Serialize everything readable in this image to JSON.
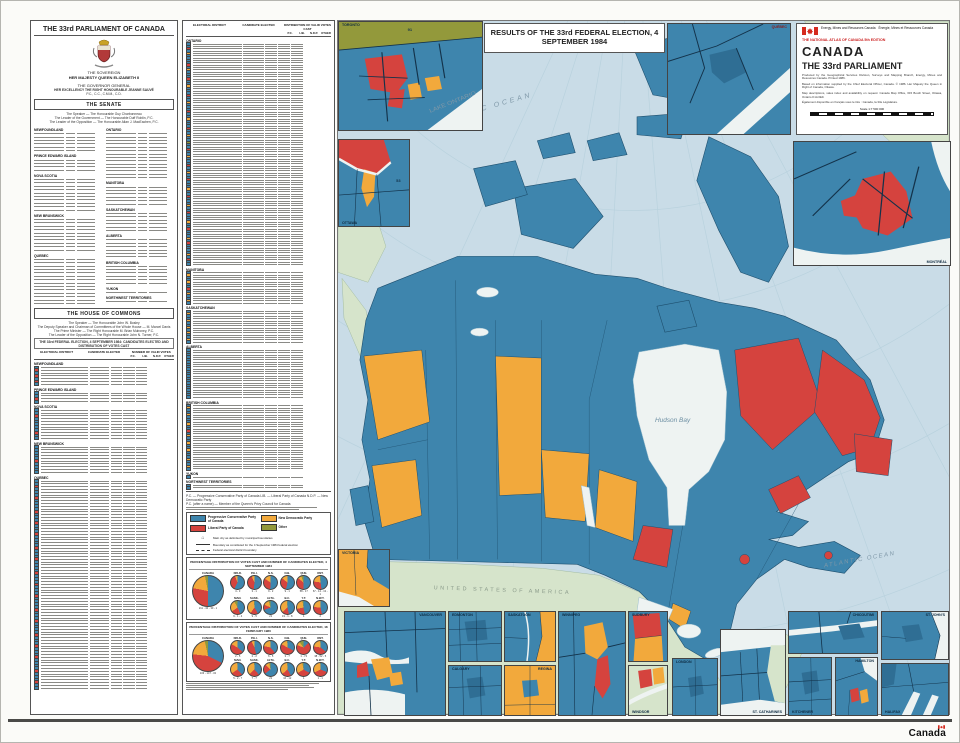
{
  "colors": {
    "pc": "#3e85ad",
    "lib": "#d5433e",
    "ndp": "#f2a93c",
    "other": "#93993b",
    "sea": "#c9dce7",
    "foreign_land": "#d6e4cb",
    "water": "#eef3f2",
    "boundary": "#1e4f6e"
  },
  "left_panel": {
    "title": "THE 33rd PARLIAMENT OF CANADA",
    "sovereign_heading": "THE SOVEREIGN",
    "sovereign_name": "HER MAJESTY QUEEN ELIZABETH II",
    "governor_heading": "THE GOVERNOR GENERAL",
    "governor_name": "HER EXCELLENCY THE RIGHT HONOURABLE JEANNE SAUVÉ",
    "governor_postnominals": "P.C., C.C., C.M.M., C.D.",
    "senate": {
      "title": "THE SENATE",
      "intro_lines": [
        "The Speaker — The Honourable Guy Charbonneau",
        "The Leader of the Government — The Honourable Duff Roblin, P.C.",
        "The Leader of the Opposition — The Honourable Allan J. MacEachen, P.C."
      ],
      "columns": [
        {
          "groups": [
            {
              "name": "NEWFOUNDLAND",
              "count": 6
            },
            {
              "name": "PRINCE EDWARD ISLAND",
              "count": 4
            },
            {
              "name": "NOVA SCOTIA",
              "count": 10
            },
            {
              "name": "NEW BRUNSWICK",
              "count": 10
            },
            {
              "name": "QUEBEC",
              "count": 14
            }
          ]
        },
        {
          "groups": [
            {
              "name": "ONTARIO",
              "count": 14
            },
            {
              "name": "MANITOBA",
              "count": 6
            },
            {
              "name": "SASKATCHEWAN",
              "count": 6
            },
            {
              "name": "ALBERTA",
              "count": 6
            },
            {
              "name": "BRITISH COLUMBIA",
              "count": 6
            },
            {
              "name": "YUKON",
              "count": 1
            },
            {
              "name": "NORTHWEST TERRITORIES",
              "count": 1
            }
          ]
        }
      ]
    },
    "commons": {
      "title": "THE HOUSE OF COMMONS",
      "intro_lines": [
        "The Speaker — The Honourable John W. Bosley",
        "The Deputy Speaker and Chairman of Committees of the Whole House — M. Marcel Danis",
        "The Prime Minister — The Right Honourable M. Brian Mulroney, P.C.",
        "The Leader of the Opposition — The Right Honourable John N. Turner, P.C."
      ],
      "table_title": "THE 33rd FEDERAL ELECTION, 4 SEPTEMBER 1984: CANDIDATES ELECTED AND DISTRIBUTION OF VOTES CAST",
      "headers": {
        "district": "ELECTORAL DISTRICT",
        "candidate": "CANDIDATE ELECTED",
        "votes": "NUMBER OF VALID VOTES",
        "dist": "DISTRIBUTION OF VALID VOTES CAST"
      },
      "sub_headers": [
        "P.C.",
        "LIB.",
        "N.D.P.",
        "OTHER"
      ],
      "sections_a": [
        {
          "name": "NEWFOUNDLAND",
          "seats": {
            "pc": 4,
            "lib": 3
          }
        },
        {
          "name": "PRINCE EDWARD ISLAND",
          "seats": {
            "pc": 3,
            "lib": 1
          }
        },
        {
          "name": "NOVA SCOTIA",
          "seats": {
            "pc": 9,
            "lib": 2
          }
        },
        {
          "name": "NEW BRUNSWICK",
          "seats": {
            "pc": 9,
            "lib": 1
          }
        },
        {
          "name": "QUEBEC",
          "seats": {
            "pc": 58,
            "lib": 17
          }
        }
      ],
      "sections_b": [
        {
          "name": "ONTARIO",
          "seats": {
            "pc": 67,
            "lib": 14,
            "ndp": 13,
            "other": 1
          }
        },
        {
          "name": "MANITOBA",
          "seats": {
            "pc": 9,
            "lib": 1,
            "ndp": 4
          }
        },
        {
          "name": "SASKATCHEWAN",
          "seats": {
            "pc": 9,
            "ndp": 5
          }
        },
        {
          "name": "ALBERTA",
          "seats": {
            "pc": 21
          }
        },
        {
          "name": "BRITISH COLUMBIA",
          "seats": {
            "pc": 19,
            "lib": 1,
            "ndp": 8
          }
        },
        {
          "name": "YUKON",
          "seats": {
            "pc": 1
          }
        },
        {
          "name": "NORTHWEST TERRITORIES",
          "seats": {
            "pc": 2
          }
        }
      ]
    },
    "footnote_lines": [
      "P.C. — Progressive Conservative Party of Canada    LIB. — Liberal Party of Canada    N.D.P. — New Democratic Party",
      "P.C. (after a name) — Member of the Queen's Privy Council for Canada"
    ]
  },
  "legend": {
    "entries": [
      {
        "party": "pc",
        "label": "Progressive Conservative Party of Canada"
      },
      {
        "party": "lib",
        "label": "Liberal Party of Canada"
      },
      {
        "party": "ndp",
        "label": "New Democratic Party"
      },
      {
        "party": "other",
        "label": "Other"
      }
    ],
    "notes": [
      {
        "symbol": "city",
        "text": "Main city as delimited by municipal boundaries"
      },
      {
        "symbol": "line",
        "text": "Boundary as constituted for the 4 September 1984 federal election"
      },
      {
        "symbol": "dline",
        "text": "Federal electoral district boundary"
      }
    ]
  },
  "chart_data": [
    {
      "type": "pie",
      "title": "PERCENTAGE DISTRIBUTION OF VOTES CAST AND NUMBER OF CANDIDATES ELECTED, 4 SEPTEMBER 1984",
      "legend_entries": [
        "P.C.",
        "LIB.",
        "N.D.P.",
        "OTHER"
      ],
      "canada": {
        "label": "CANADA",
        "values": [
          50.0,
          28.0,
          18.8,
          3.2
        ],
        "seats": "211 - 40 - 30 - 1"
      },
      "provinces": [
        {
          "label": "NFLD.",
          "values": [
            57.6,
            36.4,
            5.9,
            0.1
          ],
          "seats": "4 - 3"
        },
        {
          "label": "P.E.I.",
          "values": [
            52.0,
            41.0,
            6.5,
            0.5
          ],
          "seats": "3 - 1"
        },
        {
          "label": "N.S.",
          "values": [
            50.7,
            33.6,
            15.2,
            0.5
          ],
          "seats": "9 - 2"
        },
        {
          "label": "N.B.",
          "values": [
            53.6,
            31.9,
            14.1,
            0.4
          ],
          "seats": "9 - 1"
        },
        {
          "label": "QUE.",
          "values": [
            50.2,
            35.4,
            8.8,
            5.6
          ],
          "seats": "58 - 17"
        },
        {
          "label": "ONT.",
          "values": [
            47.6,
            29.8,
            20.8,
            1.8
          ],
          "seats": "67 - 14 - 13 - 1"
        },
        {
          "label": "MAN.",
          "values": [
            43.2,
            21.8,
            27.2,
            7.8
          ],
          "seats": "9 - 1 - 4"
        },
        {
          "label": "SASK.",
          "values": [
            41.7,
            18.2,
            38.4,
            1.7
          ],
          "seats": "9 - 5"
        },
        {
          "label": "ALTA.",
          "values": [
            68.8,
            12.7,
            14.1,
            4.4
          ],
          "seats": "21"
        },
        {
          "label": "B.C.",
          "values": [
            46.6,
            16.4,
            35.1,
            1.9
          ],
          "seats": "19 - 1 - 8"
        },
        {
          "label": "Y.T.",
          "values": [
            47.1,
            24.5,
            25.9,
            2.5
          ],
          "seats": "1"
        },
        {
          "label": "N.W.T.",
          "values": [
            46.5,
            29.5,
            23.5,
            0.5
          ],
          "seats": "2"
        }
      ]
    },
    {
      "type": "pie",
      "title": "PERCENTAGE DISTRIBUTION OF VOTES CAST AND NUMBER OF CANDIDATES ELECTED, 18 FEBRUARY 1980",
      "legend_entries": [
        "P.C.",
        "LIB.",
        "N.D.P.",
        "OTHER"
      ],
      "canada": {
        "label": "CANADA",
        "values": [
          32.5,
          44.3,
          19.8,
          3.4
        ],
        "seats": "103 - 147 - 32"
      },
      "provinces": [
        {
          "label": "NFLD.",
          "values": [
            36.1,
            46.9,
            16.7,
            0.3
          ],
          "seats": "2 - 5"
        },
        {
          "label": "P.E.I.",
          "values": [
            46.1,
            46.8,
            6.9,
            0.2
          ],
          "seats": "2 - 2"
        },
        {
          "label": "N.S.",
          "values": [
            38.7,
            39.7,
            20.9,
            0.7
          ],
          "seats": "6 - 5"
        },
        {
          "label": "N.B.",
          "values": [
            32.8,
            50.1,
            16.2,
            0.9
          ],
          "seats": "3 - 7"
        },
        {
          "label": "QUE.",
          "values": [
            12.6,
            68.2,
            9.1,
            10.1
          ],
          "seats": "1 - 74"
        },
        {
          "label": "ONT.",
          "values": [
            35.5,
            41.8,
            21.9,
            0.8
          ],
          "seats": "38 - 52 - 5"
        },
        {
          "label": "MAN.",
          "values": [
            37.7,
            28.0,
            33.5,
            0.8
          ],
          "seats": "5 - 2 - 7"
        },
        {
          "label": "SASK.",
          "values": [
            38.8,
            24.0,
            36.3,
            0.9
          ],
          "seats": "7 - 7"
        },
        {
          "label": "ALTA.",
          "values": [
            64.9,
            21.8,
            10.3,
            3.0
          ],
          "seats": "21"
        },
        {
          "label": "B.C.",
          "values": [
            41.5,
            22.2,
            35.3,
            1.0
          ],
          "seats": "16 - 12"
        },
        {
          "label": "Y.T.",
          "values": [
            33.1,
            33.2,
            30.9,
            2.8
          ],
          "seats": "1"
        },
        {
          "label": "N.W.T.",
          "values": [
            31.1,
            36.8,
            31.4,
            0.7
          ],
          "seats": "1 - 1"
        }
      ]
    }
  ],
  "map": {
    "results_title": "RESULTS OF THE 33rd FEDERAL ELECTION, 4 SEPTEMBER 1984",
    "sea_labels": {
      "arctic": "ARCTIC OCEAN",
      "hudson": "Hudson Bay",
      "atlantic": "ATLANTIC OCEAN",
      "usa": "UNITED STATES OF AMERICA",
      "lake_ontario": "LAKE ONTARIO"
    },
    "insets": [
      {
        "label": "TORONTO",
        "num": "91"
      },
      {
        "label": "QUÉBEC"
      },
      {
        "label": "OTTAWA",
        "num": "53"
      },
      {
        "label": "MONTRÉAL"
      },
      {
        "label": "VICTORIA"
      },
      {
        "label": "VANCOUVER"
      },
      {
        "label": "EDMONTON"
      },
      {
        "label": "CALGARY"
      },
      {
        "label": "SASKATOON"
      },
      {
        "label": "REGINA"
      },
      {
        "label": "WINNIPEG"
      },
      {
        "label": "SUDBURY"
      },
      {
        "label": "WINDSOR"
      },
      {
        "label": "LONDON"
      },
      {
        "label": "ST. CATHARINES"
      },
      {
        "label": "CHICOUTIMI"
      },
      {
        "label": "KITCHENER"
      },
      {
        "label": "HAMILTON"
      },
      {
        "label": "ST. JOHN'S"
      },
      {
        "label": "HALIFAX"
      }
    ]
  },
  "info_panel": {
    "agency_en": "Energy, Mines and Resources Canada",
    "agency_fr": "Énergie, Mines et Ressources Canada",
    "atlas_line": "THE NATIONAL ATLAS OF CANADA 5th EDITION",
    "country": "CANADA",
    "subtitle": "THE 33rd PARLIAMENT",
    "paragraphs": [
      "Produced by the Geographical Services Division, Surveys and Mapping Branch, Energy, Mines and Resources Canada. Printed 1986.",
      "Based on information supplied by the Chief Electoral Officer, Canada. © 1986. Her Majesty the Queen in Right of Canada, Ottawa.",
      "Map descriptions, sales index and availability on request: Canada Map Office, 615 Booth Street, Ottawa, Ontario K1A 0E9.",
      "Également disponible en français sous le titre : Canada, la 33e Législature."
    ],
    "scale_label": "Scale 1:7 500 000"
  },
  "page": {
    "wordmark": "Canada"
  }
}
